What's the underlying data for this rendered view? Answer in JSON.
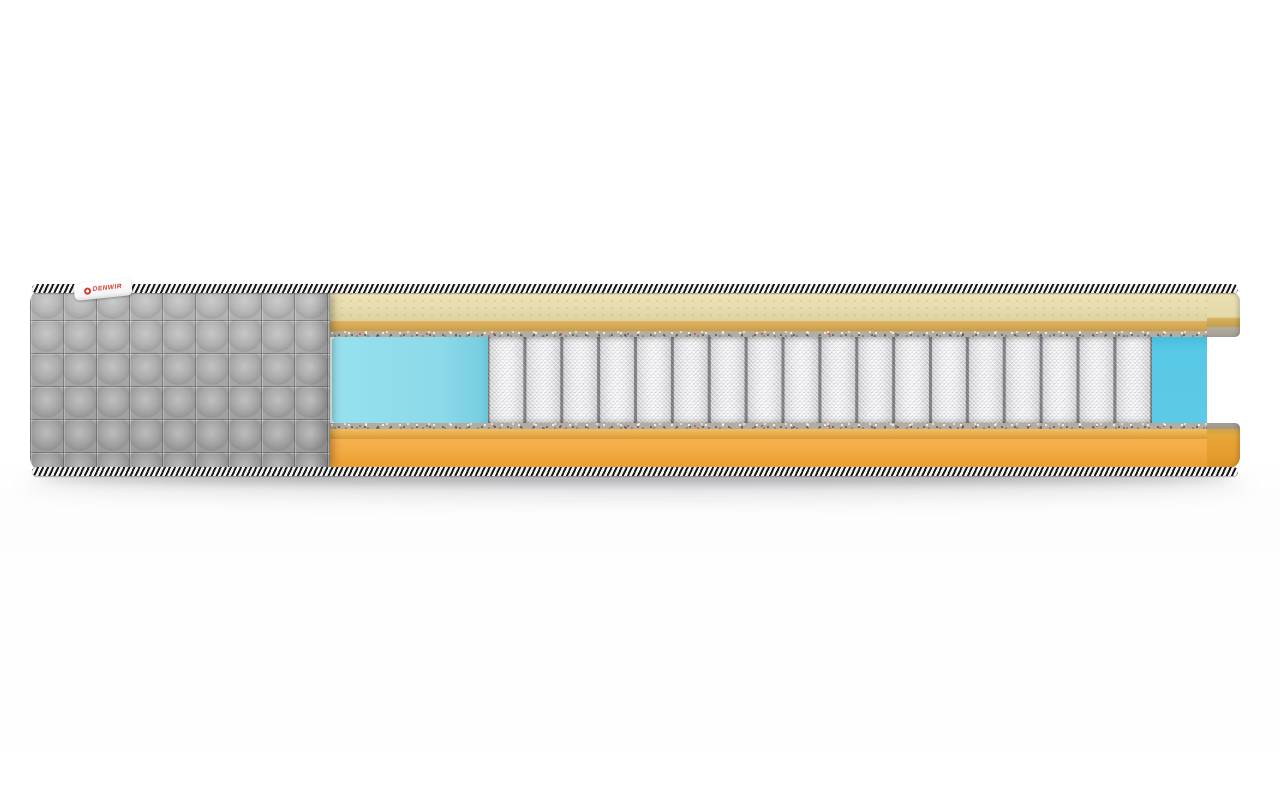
{
  "image": {
    "description": "Cutaway product render of a pocket spring mattress on a white background",
    "label": {
      "text": "DENWIR"
    },
    "springs": {
      "count": 18
    },
    "colors": {
      "cover-gray": "#a8a8a8",
      "cream": "#e6dcae",
      "tan-sheet": "#d6a955",
      "orange-sheet": "#e8ab49",
      "orange-base": "#f2aa42",
      "foam-blue-left": "#8cd9e9",
      "foam-blue-right": "#57c8e5",
      "spring-white": "#ededef",
      "felt-gray": "#b2aca3",
      "rope-dark": "#181818",
      "rope-light": "#f4f4f4",
      "label-red": "#d23b2f"
    }
  }
}
